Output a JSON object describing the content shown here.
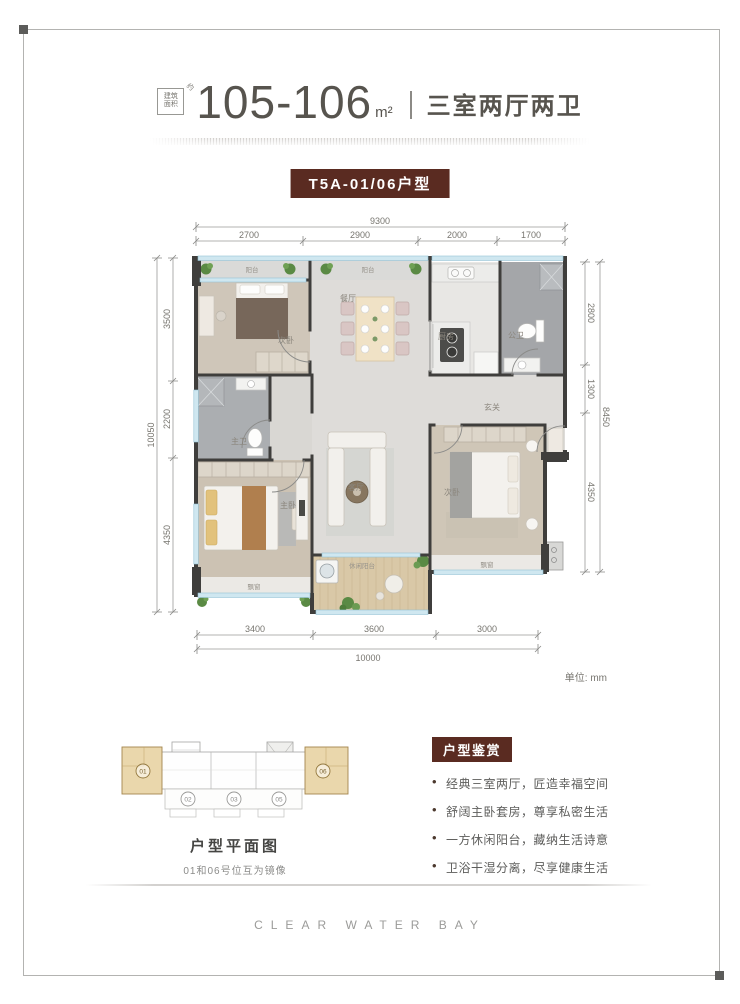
{
  "header": {
    "area_badge": {
      "line1": "建筑",
      "line2": "面积",
      "tail": "约"
    },
    "area_value": "105-106",
    "area_unit": "m²",
    "layout_text": "三室两厅两卫",
    "unit_tag": "T5A-01/06户型"
  },
  "plan": {
    "unit_note": "单位: mm",
    "rooms": {
      "balcony_left": "阳台",
      "balcony_right": "阳台",
      "bedroom_top": "次卧",
      "dining": "餐厅",
      "kitchen": "厨房",
      "bath_public": "公卫",
      "foyer": "玄关",
      "bath_master": "主卫",
      "living": "客厅",
      "master": "主卧",
      "bedroom_right": "次卧",
      "leisure_balcony": "休闲阳台",
      "bay_master": "飘窗",
      "bay_bedroom": "飘窗"
    },
    "dims": {
      "top": {
        "overall": "9300",
        "segments": [
          "2700",
          "2900",
          "2000",
          "1700"
        ]
      },
      "left": {
        "overall": "10050",
        "segments": [
          "3500",
          "2200",
          "4350"
        ]
      },
      "right": {
        "overall": "8450",
        "segments": [
          "2800",
          "1300",
          "4350"
        ]
      },
      "bottom": {
        "overall": "10000",
        "segments": [
          "3400",
          "3600",
          "3000"
        ]
      }
    }
  },
  "keyplan": {
    "title": "户型平面图",
    "note": "01和06号位互为镜像",
    "units": [
      "01",
      "02",
      "03",
      "05",
      "06"
    ]
  },
  "features": {
    "title": "户型鉴赏",
    "items": [
      "经典三室两厅，匠造幸福空间",
      "舒阔主卧套房，尊享私密生活",
      "一方休闲阳台，藏纳生活诗意",
      "卫浴干湿分离，尽享健康生活"
    ]
  },
  "footer": {
    "brand": "CLEAR WATER BAY"
  },
  "colors": {
    "accent": "#5a2b21",
    "title_text": "#57544e",
    "highlight_unit": "#ead7ac"
  }
}
